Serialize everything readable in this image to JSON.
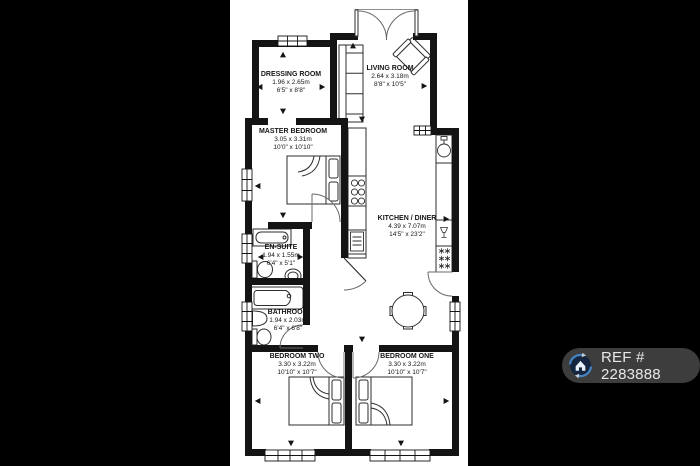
{
  "canvas": {
    "background": "#000000",
    "plan_background": "#ffffff",
    "wall_color": "#141414"
  },
  "floorplan": {
    "rooms": [
      {
        "name": "DRESSING ROOM",
        "metric": "1.96 x 2.65m",
        "imperial": "6'5\" x 8'8\""
      },
      {
        "name": "LIVING ROOM",
        "metric": "2.64 x 3.18m",
        "imperial": "8'8\" x 10'5\""
      },
      {
        "name": "MASTER BEDROOM",
        "metric": "3.05 x 3.31m",
        "imperial": "10'0\" x 10'10\""
      },
      {
        "name": "KITCHEN / DINER",
        "metric": "4.39 x 7.07m",
        "imperial": "14'5\" x 23'2\""
      },
      {
        "name": "EN-SUITE",
        "metric": "1.94 x 1.55m",
        "imperial": "6'4\" x 5'1\""
      },
      {
        "name": "BATHROOM",
        "metric": "1.94 x 2.03m",
        "imperial": "6'4\" x 6'8\""
      },
      {
        "name": "BEDROOM TWO",
        "metric": "3.30 x 3.22m",
        "imperial": "10'10\" x 10'7\""
      },
      {
        "name": "BEDROOM ONE",
        "metric": "3.30 x 3.22m",
        "imperial": "10'10\" x 10'7\""
      }
    ]
  },
  "watermark": {
    "ref_label": "REF # 2283888",
    "badge_color": "#3d3d3d",
    "text_color": "#e8e8e8",
    "ring_color": "#4586c6",
    "icon_bg": "#152740"
  }
}
